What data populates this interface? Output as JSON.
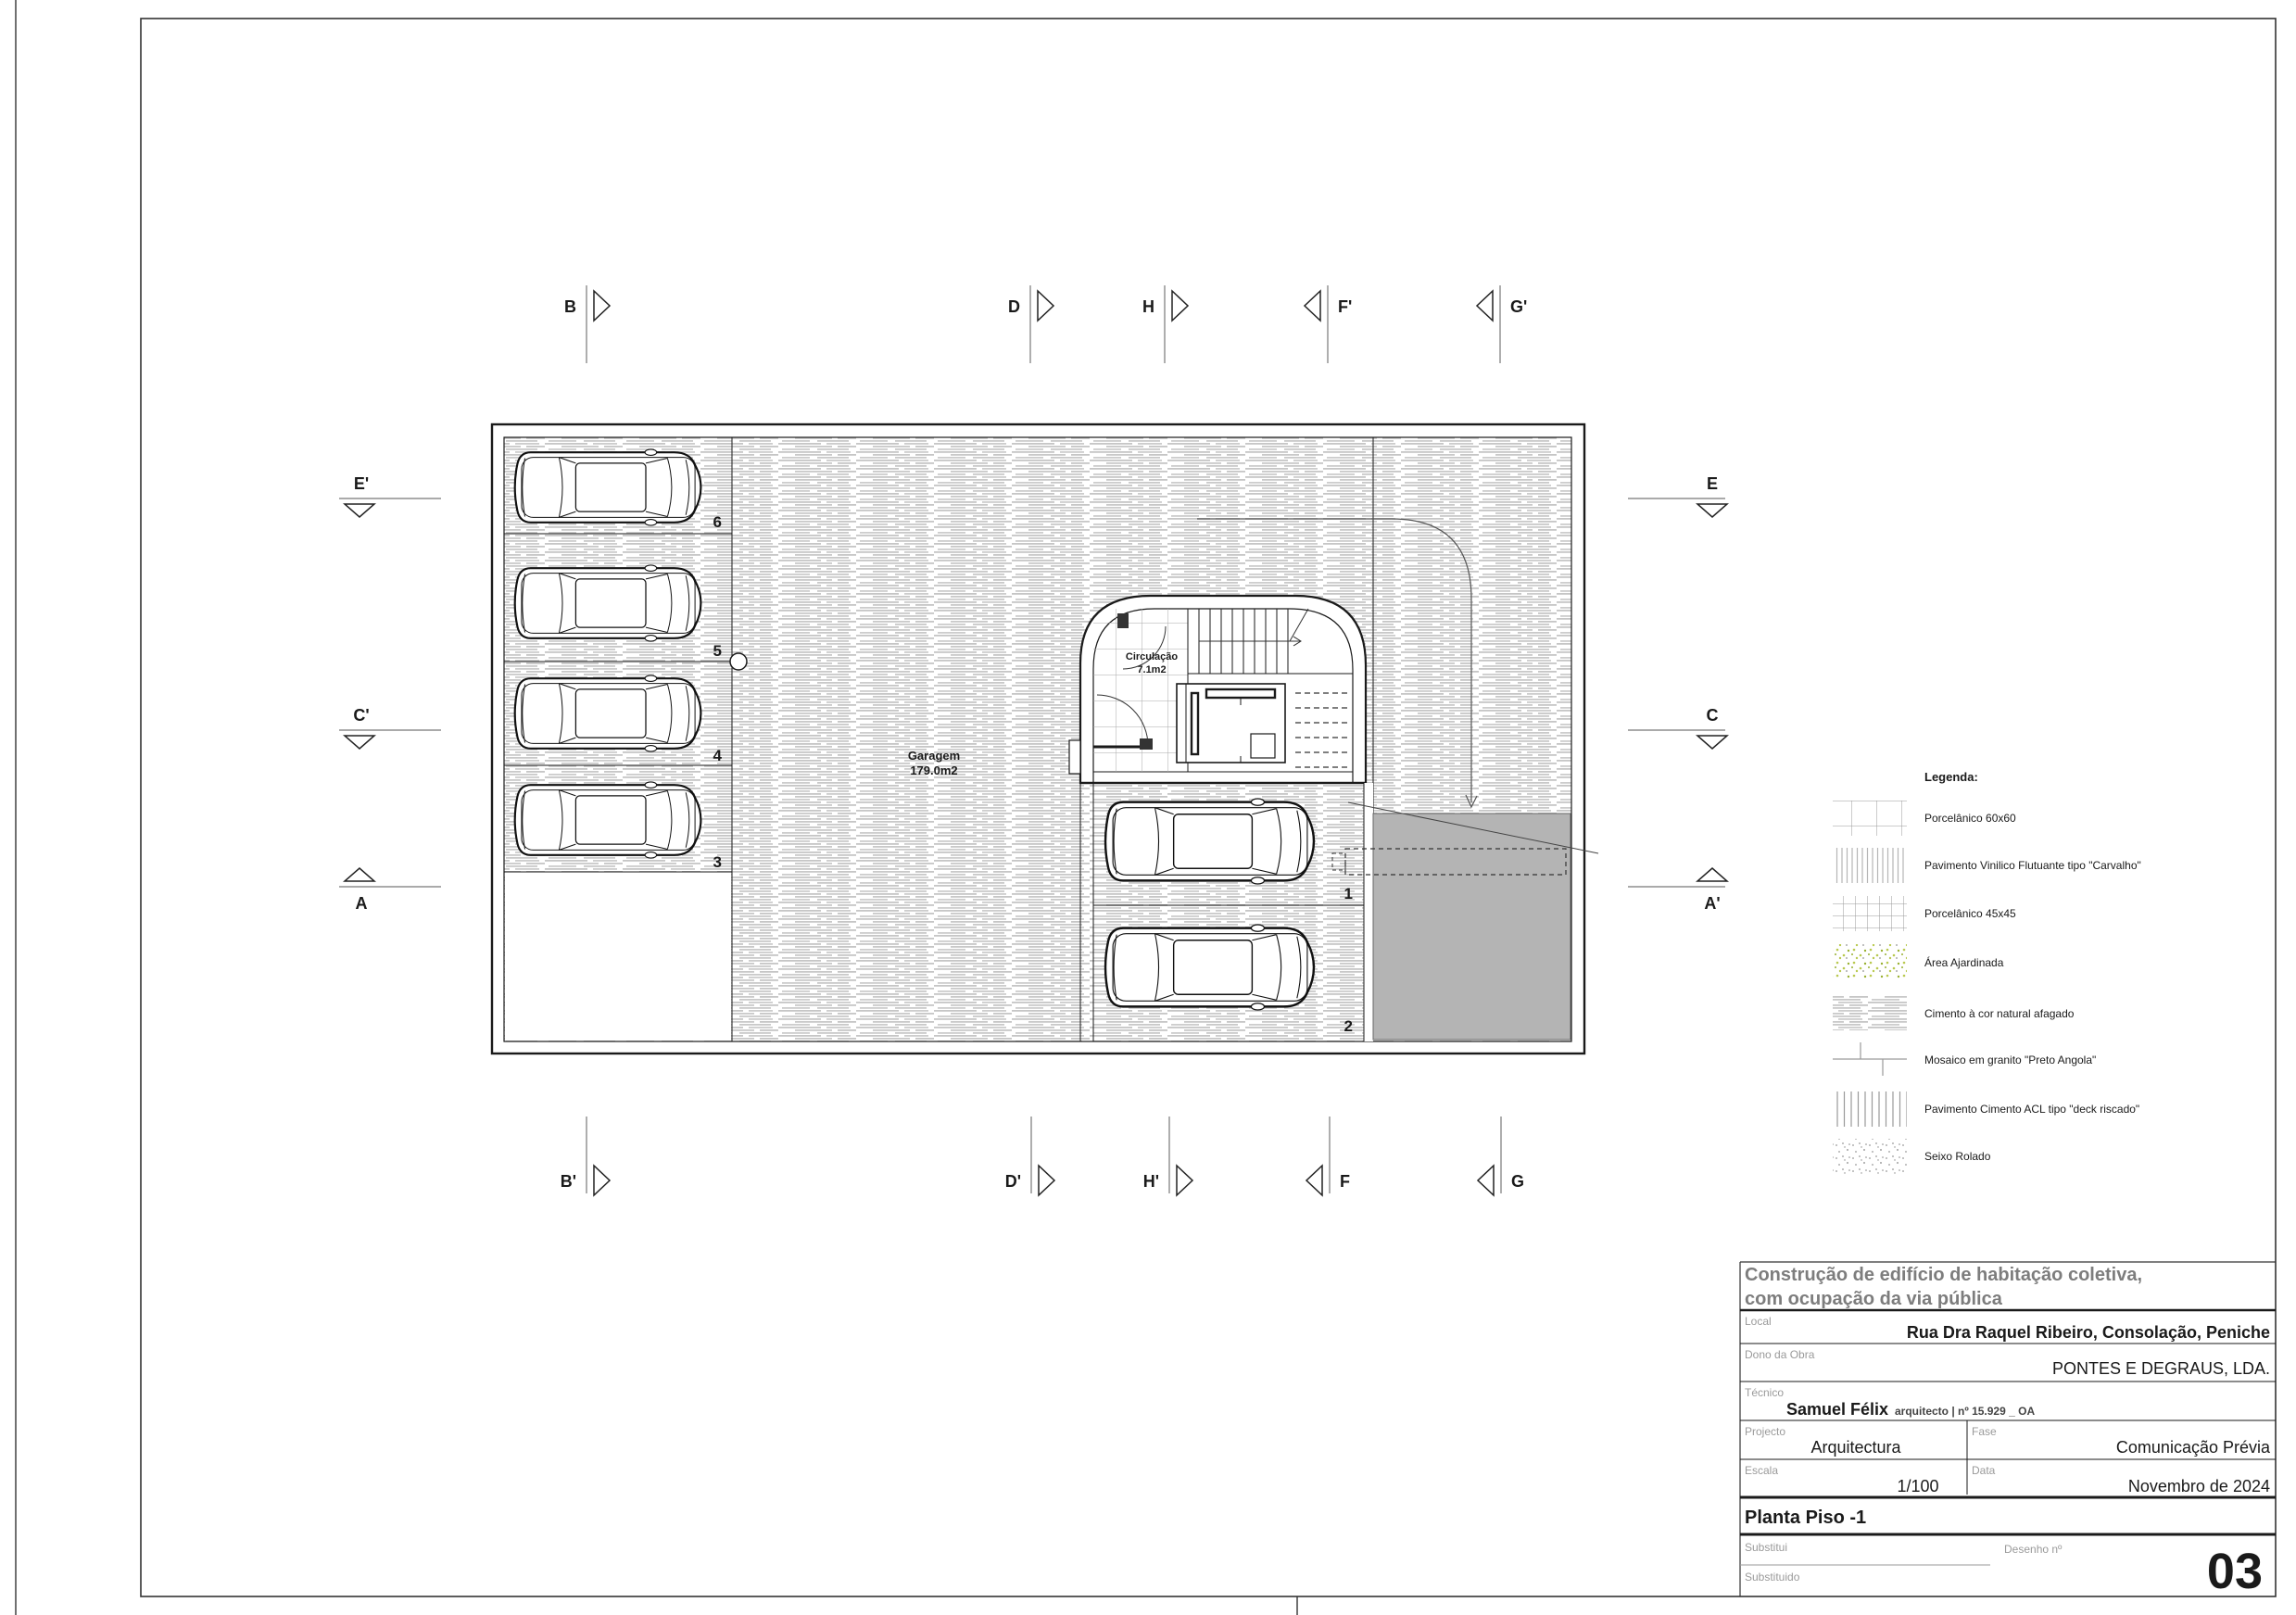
{
  "drawing": {
    "plan": {
      "garagem": {
        "name": "Garagem",
        "area": "179.0m2"
      },
      "circulacao": {
        "name": "Circulação",
        "area": "7.1m2"
      },
      "stalls": [
        "6",
        "5",
        "4",
        "3",
        "1",
        "2"
      ]
    },
    "markers": {
      "top": [
        "B",
        "D",
        "H",
        "F'",
        "G'"
      ],
      "bottom": [
        "B'",
        "D'",
        "H'",
        "F",
        "G"
      ],
      "left": [
        "E'",
        "C'",
        "A"
      ],
      "right": [
        "E",
        "C",
        "A'"
      ]
    },
    "legend": {
      "title": "Legenda:",
      "items": [
        {
          "label": "Porcelânico 60x60",
          "pattern": "grid-large"
        },
        {
          "label": "Pavimento Vinilico Flutuante tipo \"Carvalho\"",
          "pattern": "vlines-dense"
        },
        {
          "label": "Porcelânico 45x45",
          "pattern": "grid-small"
        },
        {
          "label": "Área Ajardinada",
          "pattern": "green-speckle"
        },
        {
          "label": "Cimento à cor natural afagado",
          "pattern": "cement-streaks"
        },
        {
          "label": "Mosaico em granito \"Preto Angola\"",
          "pattern": "stone-joints"
        },
        {
          "label": "Pavimento Cimento ACL tipo \"deck riscado\"",
          "pattern": "vlines"
        },
        {
          "label": "Seixo Rolado",
          "pattern": "gray-speckle"
        }
      ]
    },
    "title_block": {
      "title_line1": "Construção de edifício de habitação coletiva,",
      "title_line2": "com ocupação da via pública",
      "local_label": "Local",
      "local_value": "Rua Dra Raquel Ribeiro, Consolação, Peniche",
      "dono_label": "Dono da Obra",
      "dono_value": "PONTES E DEGRAUS, LDA.",
      "tecnico_label": "Técnico",
      "tecnico_name": "Samuel Félix",
      "tecnico_title": "arquitecto | nº 15.929 _ OA",
      "projecto_label": "Projecto",
      "projecto_value": "Arquitectura",
      "fase_label": "Fase",
      "fase_value": "Comunicação Prévia",
      "escala_label": "Escala",
      "escala_value": "1/100",
      "data_label": "Data",
      "data_value": "Novembro de 2024",
      "drawing_name": "Planta Piso -1",
      "substitui_label": "Substitui",
      "substituido_label": "Substituido",
      "desenho_label": "Desenho nº",
      "desenho_value": "03"
    },
    "colors": {
      "paper": "#ffffff",
      "line": "#1a1a1a",
      "floor_streak": "#c8c8c8",
      "lift_gray": "#b4b4b4",
      "title_gray": "#7d7d7d",
      "label_gray": "#9a9a9a",
      "garden_green": "#b9c94f"
    }
  }
}
